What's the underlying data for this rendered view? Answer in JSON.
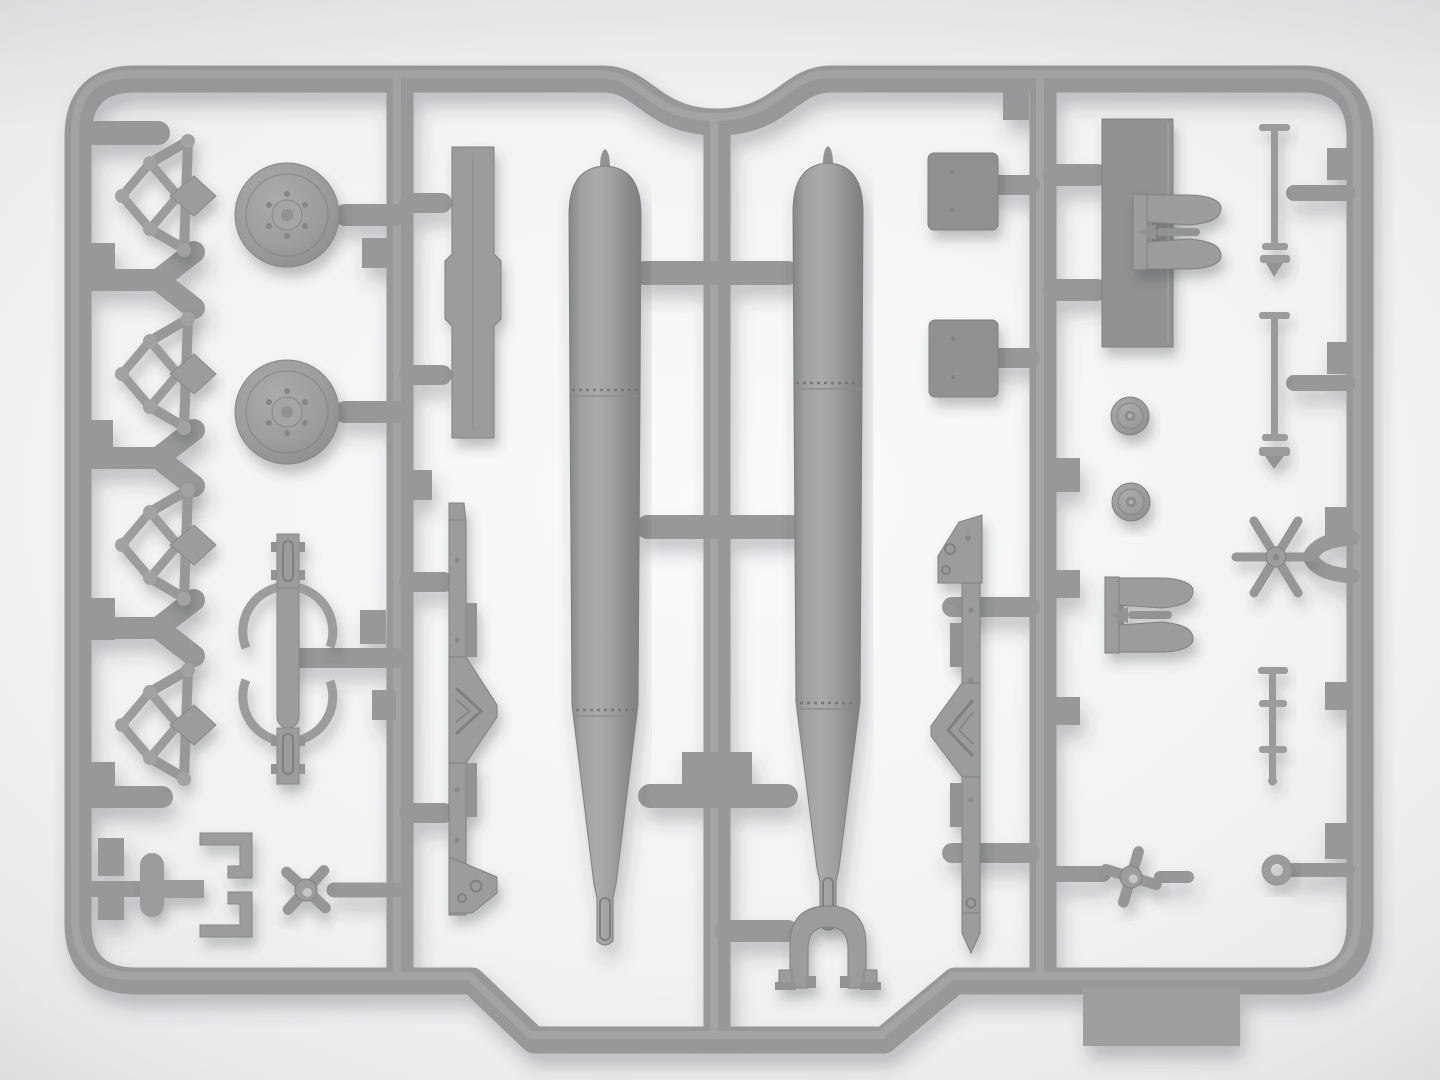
{
  "scene": {
    "type": "photograph",
    "subject": "Gray injection-molded plastic model-kit sprue holding two torpedo bodies and assorted small armament parts",
    "background": "soft light-gray studio gradient, no visible text",
    "text_visible": false
  },
  "palette": {
    "bg_corner": "#dfe1e3",
    "bg_top": "#e8e9eb",
    "bg_center": "#fbfbfc",
    "bg_bottom": "#f1f2f3",
    "plastic": "#96989a",
    "plastic_light": "#aeb0b2",
    "plastic_dark": "#7e8082",
    "plastic_face": "#9a9c9e",
    "panel_dark": "#8e9092",
    "shadow": "#3a3c40"
  },
  "sprue": {
    "material": "polystyrene",
    "color_name": "gray",
    "frame_shape": "rounded rectangle with semicircular notch at top center and stepped bulge at bottom center",
    "runners": 3,
    "parts": [
      {
        "name": "scissor-linkage",
        "count": 4,
        "area": "left-column"
      },
      {
        "name": "road-wheel-disc",
        "count": 2,
        "area": "left-column"
      },
      {
        "name": "sway-brace-clamp",
        "count": 1,
        "area": "left-column"
      },
      {
        "name": "corner-bracket",
        "count": 1,
        "area": "bottom-left"
      },
      {
        "name": "four-blade-propeller",
        "count": 2,
        "area": "bottom-left-and-bottom-right"
      },
      {
        "name": "slotted-plate",
        "count": 1,
        "area": "mid-left"
      },
      {
        "name": "bomb-rack-rail",
        "count": 2,
        "area": "mid-left-and-mid-right"
      },
      {
        "name": "torpedo-body",
        "count": 2,
        "area": "center"
      },
      {
        "name": "tail-clamp-arch",
        "count": 1,
        "area": "bottom-center"
      },
      {
        "name": "square-panel",
        "count": 2,
        "area": "mid-right"
      },
      {
        "name": "large-rect-panel",
        "count": 1,
        "area": "right-column"
      },
      {
        "name": "release-fork",
        "count": 2,
        "area": "right-column"
      },
      {
        "name": "small-wheel",
        "count": 2,
        "area": "right-column"
      },
      {
        "name": "axle-rod",
        "count": 3,
        "area": "right-column"
      },
      {
        "name": "six-spoke-hub",
        "count": 1,
        "area": "right-column"
      },
      {
        "name": "tow-ring",
        "count": 1,
        "area": "bottom-right"
      }
    ]
  }
}
